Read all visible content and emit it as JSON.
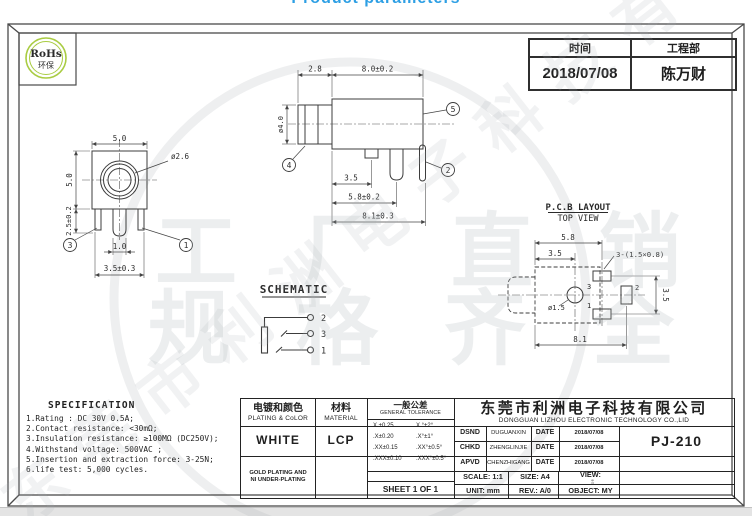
{
  "page": {
    "title": "Product parameters"
  },
  "rohs": {
    "line1": "RoHs",
    "line2": "环保"
  },
  "header_table": {
    "time_label": "时间",
    "dept_label": "工程部",
    "time_value": "2018/07/08",
    "dept_value": "陈万财"
  },
  "front_view": {
    "dim_width": "5.0",
    "dim_height": "5.0",
    "dim_shoulder": "2.5±0.2",
    "hole": "ø2.6",
    "pin_pitch": "1.0",
    "pin_span": "3.5±0.3",
    "callout_left": "3",
    "callout_right": "1"
  },
  "side_view": {
    "dim_tip": "2.8",
    "dim_body": "8.0±0.2",
    "dim_dia": "ø4.0",
    "dim_pin1": "3.5",
    "dim_pin2": "5.8±0.2",
    "dim_total": "8.1±0.3",
    "callout_tip": "4",
    "callout_body": "5",
    "callout_pin": "2"
  },
  "schematic": {
    "title": "SCHEMATIC",
    "pin_top": "2",
    "pin_mid": "3",
    "pin_bot": "1"
  },
  "pcb": {
    "title": "P.C.B LAYOUT",
    "subtitle": "TOP VIEW",
    "dim_width": "5.8",
    "dim_hole_x": "3.5",
    "slot_note": "3-(1.5×0.8)",
    "hole": "ø1.5",
    "dim_pitch": "3.5",
    "dim_total": "8.1",
    "pad_top": "3",
    "pad_right": "2",
    "pad_bottom": "1"
  },
  "spec": {
    "title": "SPECIFICATION",
    "lines": [
      "1.Rating : DC 30V 0.5A;",
      "2.Contact resistance: <30mΩ;",
      "3.Insulation resistance: ≥100MΩ (DC250V);",
      "4.Withstand voltage: 500VAC ;",
      "5.Insertion and extraction force: 3-25N;",
      "6.life test: 5,000 cycles."
    ]
  },
  "title_block": {
    "plating_cn": "电镀和颜色",
    "plating_en": "PLATING & CoLOR",
    "material_cn": "材料",
    "material_en": "MATERIAL",
    "tol_cn": "一般公差",
    "tol_en": "GENERAL TOLERANCE",
    "tol": [
      [
        "X.±0.25",
        "X.°±2°"
      ],
      [
        ".X±0.20",
        ".X°±1°"
      ],
      [
        ".XX±0.15",
        ".XX°±0.5°"
      ],
      [
        ".XXX±0.10",
        ".XXX°±0.5°"
      ]
    ],
    "plating_value": "WHITE",
    "material_value": "LCP",
    "note1": "GOLD PLATING AND",
    "note2": "NI UNDER-PLATING",
    "sheet": "SHEET 1 OF 1",
    "company_cn": "东莞市利洲电子科技有限公司",
    "company_en": "DONGGUAN LIZHOU ELECTRONIC TECHNOLOGY CO.,LID",
    "rows": [
      {
        "label": "DSND",
        "name": "DUGUANXIN",
        "date_label": "DATE",
        "date": "2018/07/08"
      },
      {
        "label": "CHKD",
        "name": "ZHENGLINJIE",
        "date_label": "DATE",
        "date": "2018/07/08"
      },
      {
        "label": "APVD",
        "name": "CHENZHIGANG",
        "date_label": "DATE",
        "date": "2018/07/08"
      }
    ],
    "part_number": "PJ-210",
    "scale": "SCALE: 1:1",
    "size": "SIZE: A4",
    "view": "VIEW:",
    "unit": "UNIT: mm",
    "rev": "REV.: A/0",
    "object": "OBJECT: MY"
  },
  "watermark": {
    "big1": "工厂直销",
    "big2": "规格齐全",
    "diagonal": "东莞市利洲电子科技有限公司"
  }
}
